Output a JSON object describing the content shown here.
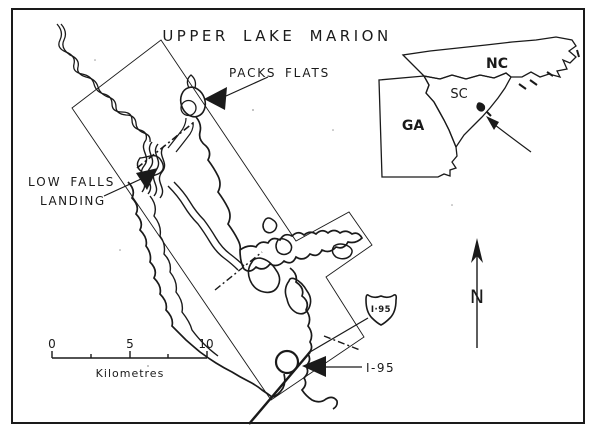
{
  "figure_title": "UPPER LAKE MARION",
  "map_labels": {
    "packs_flats": "PACKS FLATS",
    "low_falls_line1": "LOW FALLS",
    "low_falls_line2": "LANDING",
    "interstate_label": "I-95",
    "interstate_shield": "I·95"
  },
  "scale_bar": {
    "tick_0": "0",
    "tick_5": "5",
    "tick_10": "10",
    "units": "Kilometres"
  },
  "inset_map": {
    "state_nc": "NC",
    "state_sc": "SC",
    "state_ga": "GA"
  },
  "north_arrow": {
    "label": "N"
  },
  "colors": {
    "ink": "#1a1a1a",
    "paper": "#ffffff",
    "light_ink": "#555555"
  }
}
